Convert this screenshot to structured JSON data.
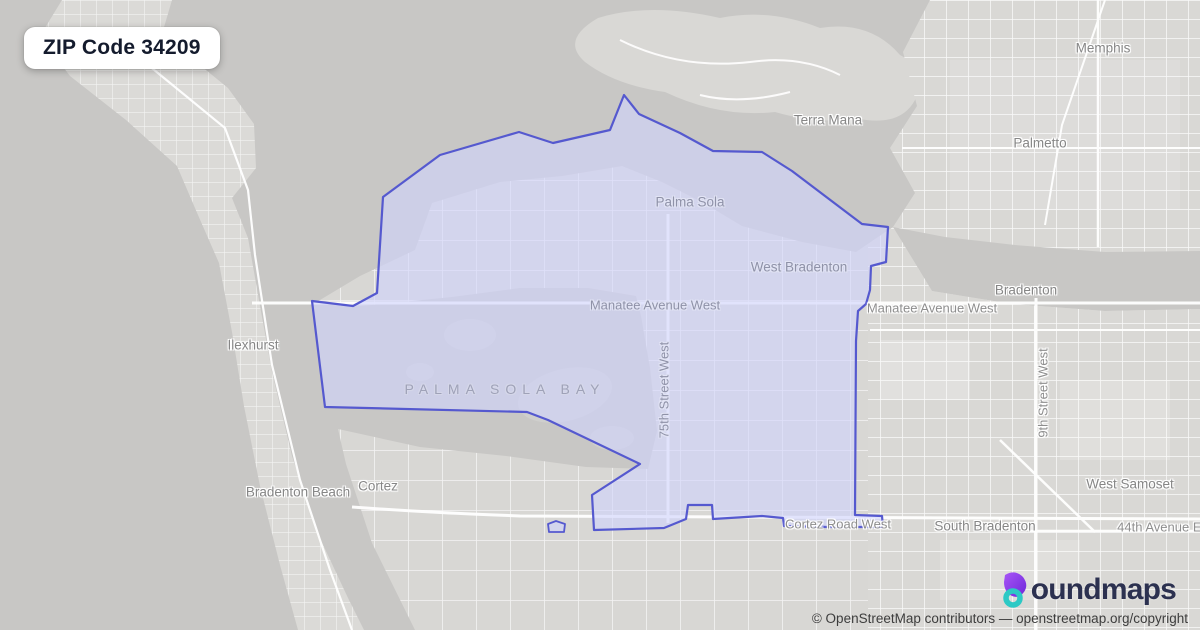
{
  "title_badge": {
    "label": "ZIP Code 34209"
  },
  "map": {
    "region_name": "ZIP Code 34209 boundary polygon",
    "labels": [
      {
        "text": "Terra Mana",
        "kind": "place"
      },
      {
        "text": "Memphis",
        "kind": "place"
      },
      {
        "text": "Palmetto",
        "kind": "place"
      },
      {
        "text": "Palma Sola",
        "kind": "place"
      },
      {
        "text": "West Bradenton",
        "kind": "place"
      },
      {
        "text": "Manatee Avenue West",
        "kind": "road"
      },
      {
        "text": "Manatee Avenue West",
        "kind": "road"
      },
      {
        "text": "Bradenton",
        "kind": "place"
      },
      {
        "text": "9th Street West",
        "kind": "road-vertical"
      },
      {
        "text": "75th Street West",
        "kind": "road-vertical"
      },
      {
        "text": "Ilexhurst",
        "kind": "place"
      },
      {
        "text": "PALMA SOLA BAY",
        "kind": "water"
      },
      {
        "text": "Bradenton Beach",
        "kind": "place"
      },
      {
        "text": "Cortez",
        "kind": "place"
      },
      {
        "text": "Cortez Road West",
        "kind": "road"
      },
      {
        "text": "South Bradenton",
        "kind": "place"
      },
      {
        "text": "West Samoset",
        "kind": "place"
      },
      {
        "text": "44th Avenue East",
        "kind": "road"
      }
    ],
    "colors": {
      "water": "#c8c7c5",
      "land": "#d8d7d4",
      "road": "#ffffff",
      "boundary_stroke": "#5559cf",
      "boundary_fill": "rgba(208,212,252,0.62)"
    }
  },
  "footer": {
    "logo": {
      "icon": "boundmaps-drop-icon",
      "text": "oundmaps",
      "full_name": "boundmaps"
    },
    "attribution": "© OpenStreetMap contributors — openstreetmap.org/copyright"
  }
}
